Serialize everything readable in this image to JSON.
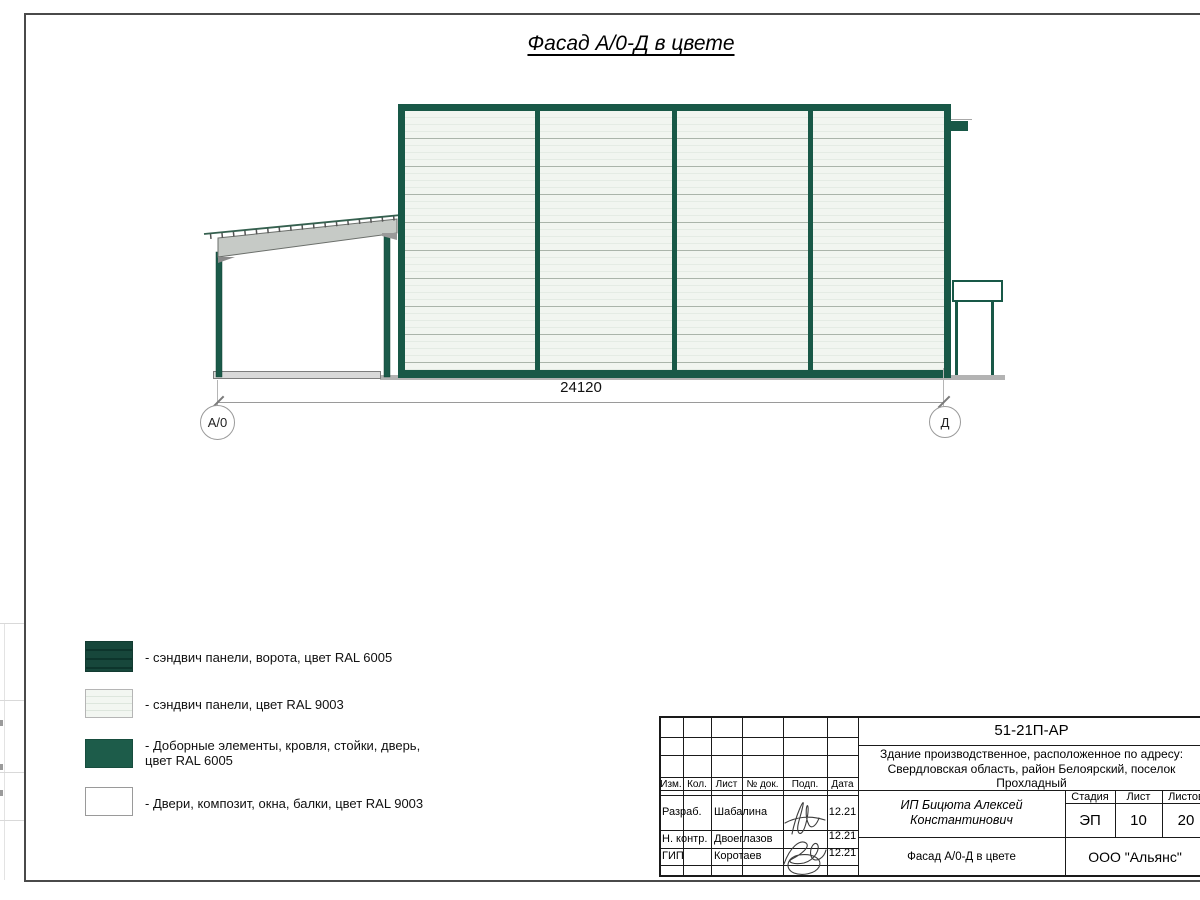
{
  "page_title": "Фасад А/0-Д в цвете",
  "drawing": {
    "dimension": "24120",
    "axis_left": "А/0",
    "axis_right": "Д"
  },
  "legend": [
    {
      "swatch": "gate-sandwich-green-striped",
      "label": "- сэндвич панели, ворота, цвет RAL 6005"
    },
    {
      "swatch": "sandwich-panel-white-striped",
      "label": "- сэндвич панели, цвет RAL 9003"
    },
    {
      "swatch": "trim-elements-green-solid",
      "label": "- Доборные элементы, кровля, стойки, дверь,\nцвет RAL 6005"
    },
    {
      "swatch": "doors-windows-white",
      "label": "- Двери, композит, окна, балки, цвет RAL 9003"
    }
  ],
  "title_block": {
    "doc_number": "51-21П-АР",
    "project_description": "Здание производственное, расположенное по адресу:\nСвердловская область, район Белоярский, поселок\nПрохладный",
    "columns": {
      "izm": "Изм.",
      "kol": "Кол.",
      "list": "Лист",
      "doc": "№ док.",
      "podp": "Подп.",
      "data": "Дата"
    },
    "rows": [
      {
        "role": "Разраб.",
        "name": "Шабалина",
        "date": "12.21"
      },
      {
        "role": "Н. контр.",
        "name": "Двоеглазов",
        "date": "12.21"
      },
      {
        "role": "ГИП",
        "name": "Коротаев",
        "date": "12.21"
      }
    ],
    "client": "ИП Бицюта Алексей\nКонстантинович",
    "stage_label": "Стадия",
    "sheet_label": "Лист",
    "sheets_label": "Листов",
    "stage": "ЭП",
    "sheet": "10",
    "sheets": "20",
    "drawing_name": "Фасад А/0-Д в цвете",
    "organization": "ООО \"Альянс\""
  },
  "colors": {
    "frame_green_ral6005": "#185847",
    "gate_green_striped": "#17473b",
    "panel_white_ral9003": "#f1f5f0",
    "beam_gray": "#c6cac6"
  }
}
